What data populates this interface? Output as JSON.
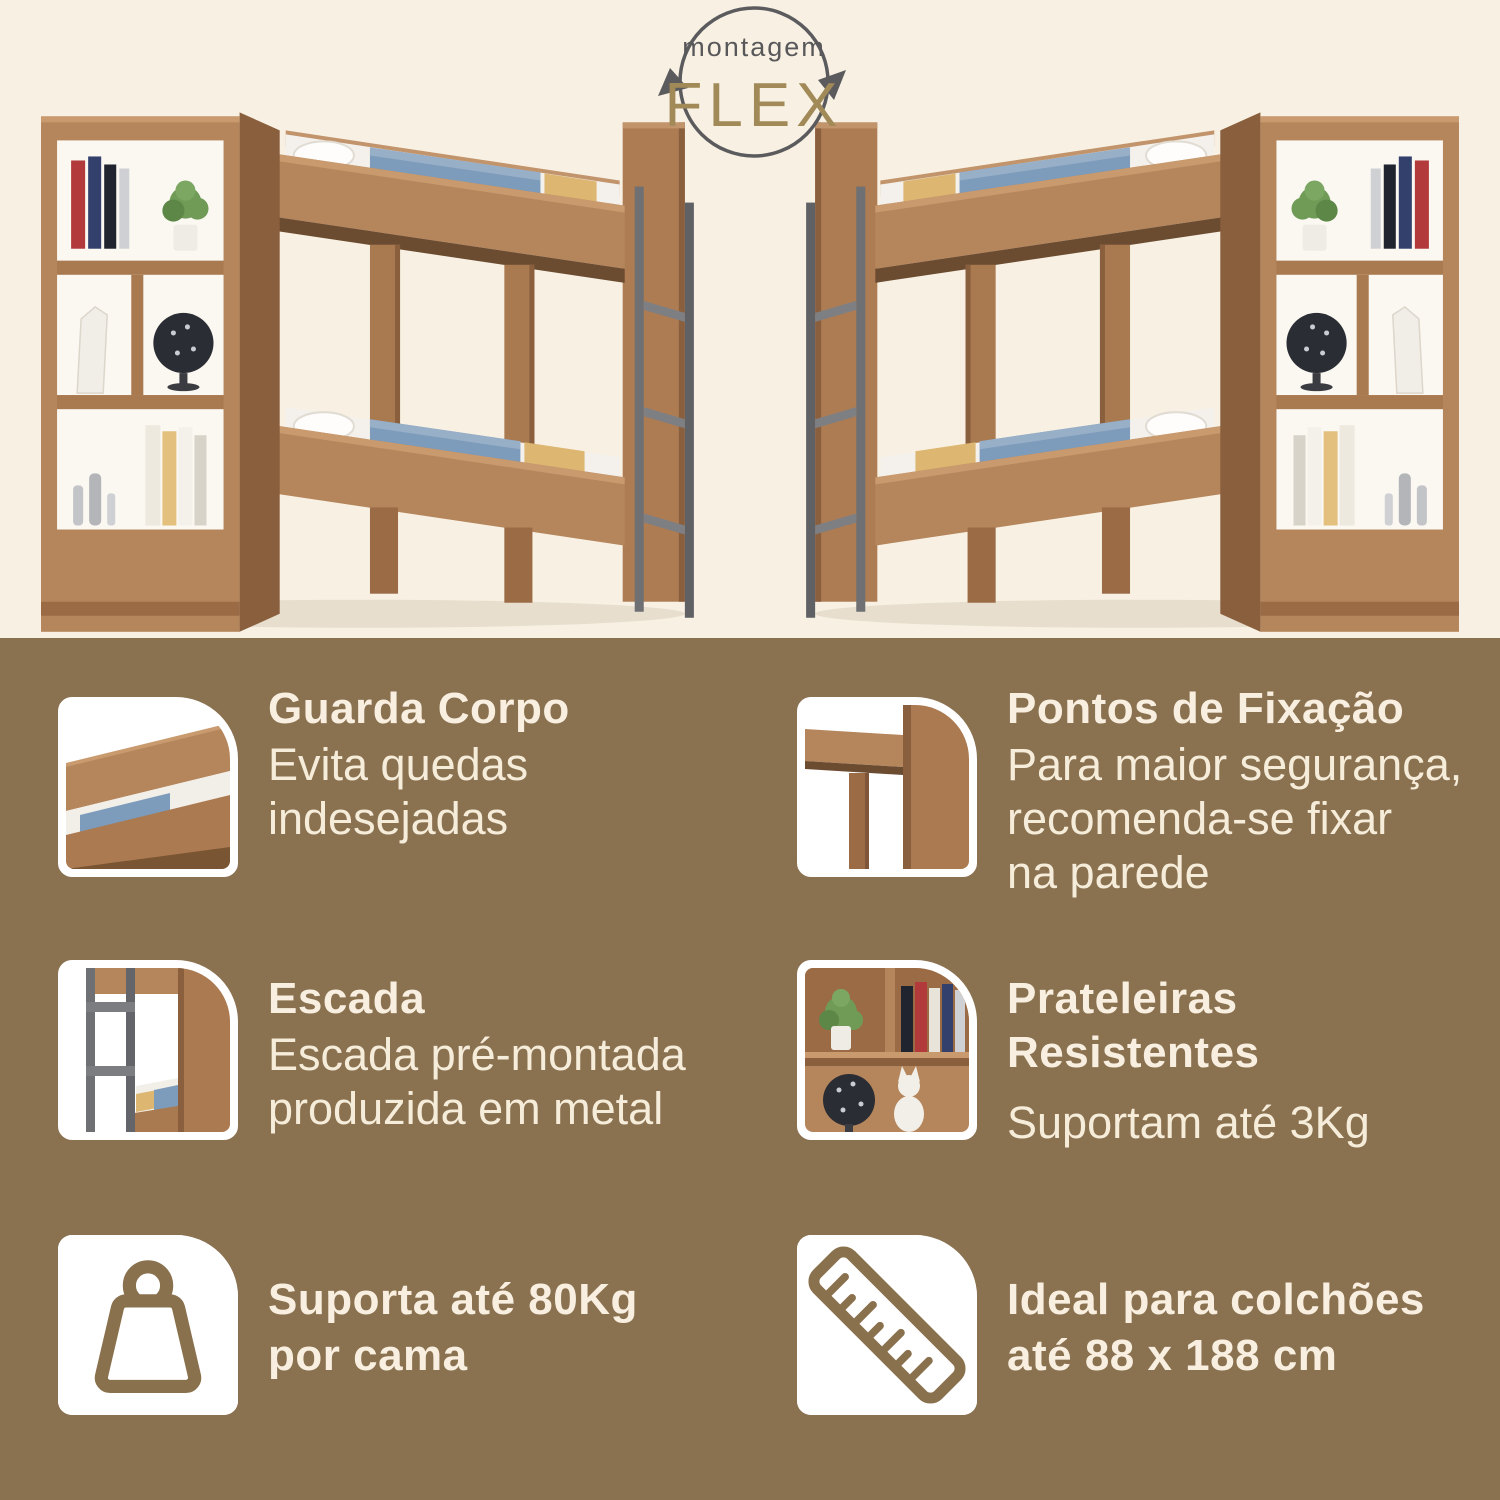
{
  "colors": {
    "background_top": "#f8f1e3",
    "background_bottom": "#8a7150",
    "text_cream": "#f8efe0",
    "flex_gold": "#a18a58",
    "logo_gray": "#58585a",
    "wood": "#b5855c",
    "metal_gray": "#6f7073",
    "blanket_blue": "#7d9bba",
    "blanket_yellow": "#ddb671"
  },
  "logo": {
    "icon": "circular-arrows-icon",
    "top_text": "montagem",
    "main_text": "FLEX"
  },
  "hero": {
    "left_image": "bunk-bed-with-bookshelf",
    "right_image": "bunk-bed-with-bookshelf-mirrored"
  },
  "features": [
    {
      "id": "guarda-corpo",
      "thumbnail": "guard-rail-photo",
      "title": "Guarda Corpo",
      "body": "Evita quedas\nindesejadas"
    },
    {
      "id": "pontos-de-fixacao",
      "thumbnail": "frame-corner-photo",
      "title": "Pontos de Fixação",
      "body": "Para maior segurança,\nrecomenda-se fixar\nna parede"
    },
    {
      "id": "escada",
      "thumbnail": "metal-ladder-photo",
      "title": "Escada",
      "body": "Escada pré-montada\nproduzida em metal"
    },
    {
      "id": "prateleiras-resistentes",
      "thumbnail": "shelves-photo",
      "title": "Prateleiras\nResistentes",
      "body": "Suportam até 3Kg"
    }
  ],
  "badges": [
    {
      "id": "capacidade",
      "icon": "weight-icon",
      "text": "Suporta até 80Kg\npor cama"
    },
    {
      "id": "colchao",
      "icon": "ruler-icon",
      "text": "Ideal para colchões\naté 88 x 188 cm"
    }
  ]
}
